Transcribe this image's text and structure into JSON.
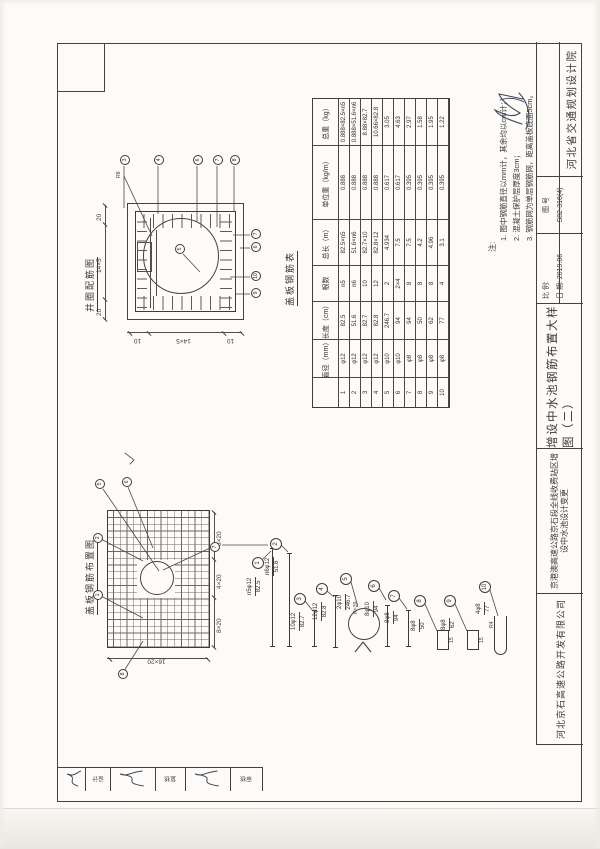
{
  "colors": {
    "paper": "#fcfbf7",
    "line": "#43423e",
    "accent": "#3a3937"
  },
  "title_block": {
    "company": "河北京石高速公路开发有限公司",
    "project_line1": "京港澳高速公路京石段全线收费站区增",
    "project_line2": "设中水池设计变更",
    "drawing_title": "增设中水池钢筋布置大样图（二）",
    "scale_label": "比 例:",
    "date_label": "日 期: 2019.06",
    "figure_label": "图  号",
    "figure_no": "S82-316(4)",
    "institute": "河北省交通规划设计院"
  },
  "notes": {
    "label": "注:",
    "items": [
      "1. 图中钢筋直径以mm计，其余均以cm计；",
      "2. 混凝土保护层厚度3cm；",
      "3. 钢筋网为单层钢筋网，距离盖板底面5cm。"
    ]
  },
  "rebar_table": {
    "title": "盖板钢筋表",
    "headers": [
      "",
      "直径（mm）",
      "长度（cm）",
      "根数",
      "总长（m）",
      "单位重（kg/m）",
      "总重（kg）"
    ],
    "rows": [
      [
        "1",
        "φ12",
        "82.5",
        "n5",
        "82.5×n5",
        "0.888",
        "0.888×82.5×n5"
      ],
      [
        "2",
        "φ12",
        "51.6",
        "n6",
        "51.6×n6",
        "0.888",
        "0.888×51.6×n6"
      ],
      [
        "3",
        "φ12",
        "82.7",
        "10",
        "82.7×10",
        "0.888",
        "8.88×82.7"
      ],
      [
        "4",
        "φ12",
        "82.8",
        "12",
        "82.8×12",
        "0.888",
        "10.66×82.8"
      ],
      [
        "5",
        "φ10",
        "246.7",
        "2",
        "4.934",
        "0.617",
        "3.05"
      ],
      [
        "6",
        "φ10",
        "94",
        "2×4",
        "7.5",
        "0.617",
        "4.63"
      ],
      [
        "7",
        "φ8",
        "94",
        "8",
        "7.5",
        "0.395",
        "2.97"
      ],
      [
        "8",
        "φ8",
        "50",
        "8",
        "4.2",
        "0.395",
        "1.58"
      ],
      [
        "9",
        "φ8",
        "62",
        "8",
        "4.96",
        "0.395",
        "1.95"
      ],
      [
        "10",
        "φ8",
        "77",
        "4",
        "3.1",
        "0.395",
        "1.22"
      ]
    ]
  },
  "collar_diagram": {
    "title": "井圈配筋图",
    "dims_top": [
      "20",
      "14×5",
      "20"
    ],
    "dims_left": [
      "10",
      "14×5",
      "10"
    ],
    "center_callout": "5",
    "right_callouts": [
      "3",
      "4",
      "6",
      "7",
      "8"
    ],
    "bottom_callouts": [
      "9",
      "10",
      "6",
      "7"
    ],
    "side_label": "R8"
  },
  "slab_diagram": {
    "title": "盖板钢筋布置图",
    "dims_bottom": [
      "8×20",
      "4×20",
      "8×20"
    ],
    "dim_left": "16×20",
    "callouts": [
      "1",
      "2",
      "5",
      "6",
      "7",
      "8"
    ]
  },
  "shapes": [
    {
      "no": "1",
      "mark": "n5φ12",
      "len": "82.5",
      "extra": ""
    },
    {
      "no": "2",
      "mark": "n6φ12",
      "len": "51.6",
      "extra": ""
    },
    {
      "no": "3",
      "mark": "10φ12",
      "len": "82.7",
      "extra": ""
    },
    {
      "no": "4",
      "mark": "12φ12",
      "len": "82.8",
      "extra": ""
    },
    {
      "no": "5",
      "mark": "2φ10",
      "len": "246.7",
      "extra": "R=39"
    },
    {
      "no": "6",
      "mark": "8φ10",
      "len": "94",
      "extra": ""
    },
    {
      "no": "7",
      "mark": "8φ8",
      "len": "94",
      "extra": ""
    },
    {
      "no": "8",
      "mark": "8φ8",
      "len": "50",
      "extra": "15"
    },
    {
      "no": "9",
      "mark": "8φ8",
      "len": "62",
      "extra": "15"
    },
    {
      "no": "10",
      "mark": "4φ8",
      "len": "77",
      "extra": "R4"
    }
  ],
  "signatures": {
    "labels": [
      "设计",
      "复核",
      "审核"
    ]
  }
}
